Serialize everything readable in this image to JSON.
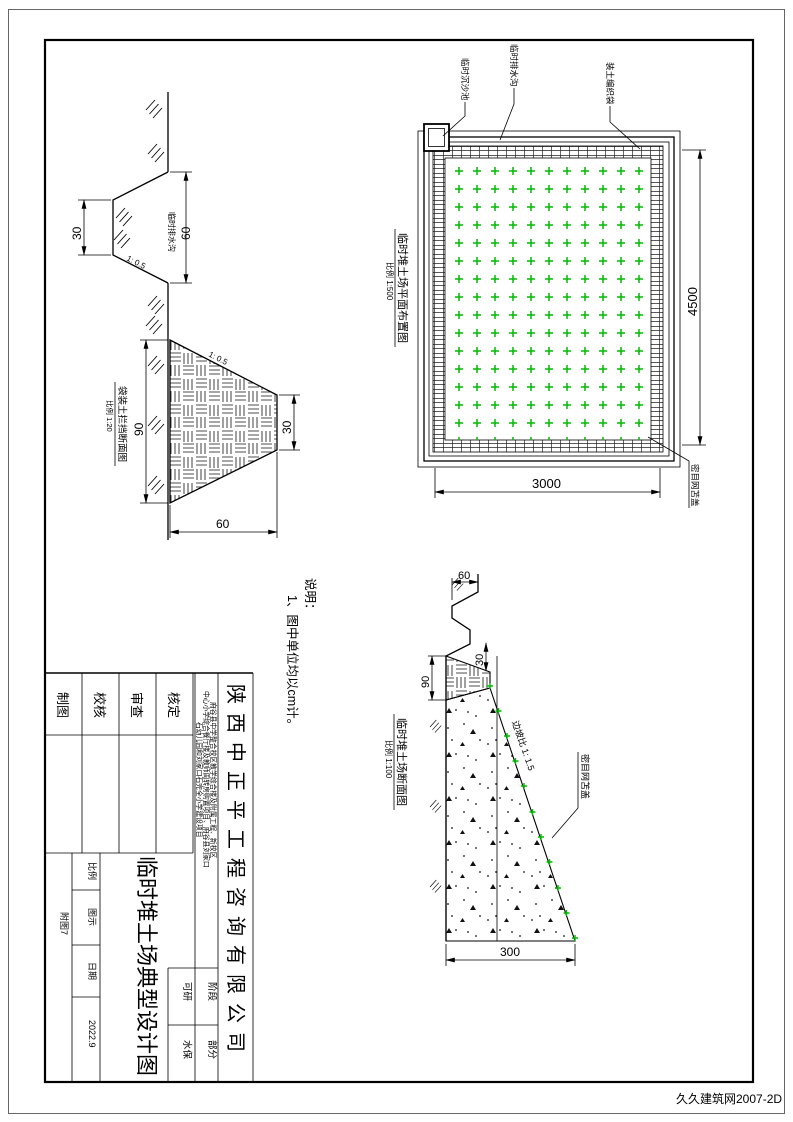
{
  "notes": {
    "heading": "说明：",
    "line1": "1、图中单位均以cm计。"
  },
  "plan": {
    "title": "临时堆土场平面布置图",
    "scale": "比例 1:500",
    "dim_width": "3000",
    "dim_height": "4500",
    "label_pool": "临时沉沙池",
    "label_ditch": "临时排水沟",
    "label_bags": "装土编织袋",
    "label_net": "密目网苫盖"
  },
  "ditch_detail": {
    "label": "临时排水沟",
    "dim_top": "60",
    "dim_bottom": "30",
    "slope": "1: 0.5"
  },
  "barrier_detail": {
    "title": "袋装土拦挡断面图",
    "scale": "比例 1:20",
    "dim_height": "90",
    "dim_top": "30",
    "dim_base": "60",
    "slope": "1: 0.5"
  },
  "section": {
    "title": "临时堆土场断面图",
    "scale": "比例 1:100",
    "dim_ditch": "60",
    "dim_wall_h": "90",
    "dim_wall_t": "30",
    "dim_height": "300",
    "slope_label": "边坡比 1: 1.5",
    "label_net": "密目网苫盖"
  },
  "titleblock": {
    "company": "陕西中正平工程咨询有限公司",
    "project_line1": "府谷县中学整合校区教学综合楼及附属工程、新校区",
    "project_line2": "中心小学综合餐厅楼及教师周转房购置项目、府谷县刘家口",
    "project_line3": "石幼儿园和刘家口石完全小学建设项目",
    "drawing_title": "临时堆土场典型设计图",
    "sign_rows": [
      "制图",
      "校核",
      "审查",
      "核定"
    ],
    "stage_label": "可研",
    "stage_value": "阶段",
    "part_label": "水保",
    "part_value": "部分",
    "scale_label": "比例",
    "scale_value": "图示",
    "date_label": "日期",
    "date_value": "2022.9",
    "fig_no": "附图7"
  },
  "watermark": {
    "text": "久久建筑网2007-2D"
  },
  "colors": {
    "green": "#00bb00",
    "watermark": "#2090c8"
  }
}
